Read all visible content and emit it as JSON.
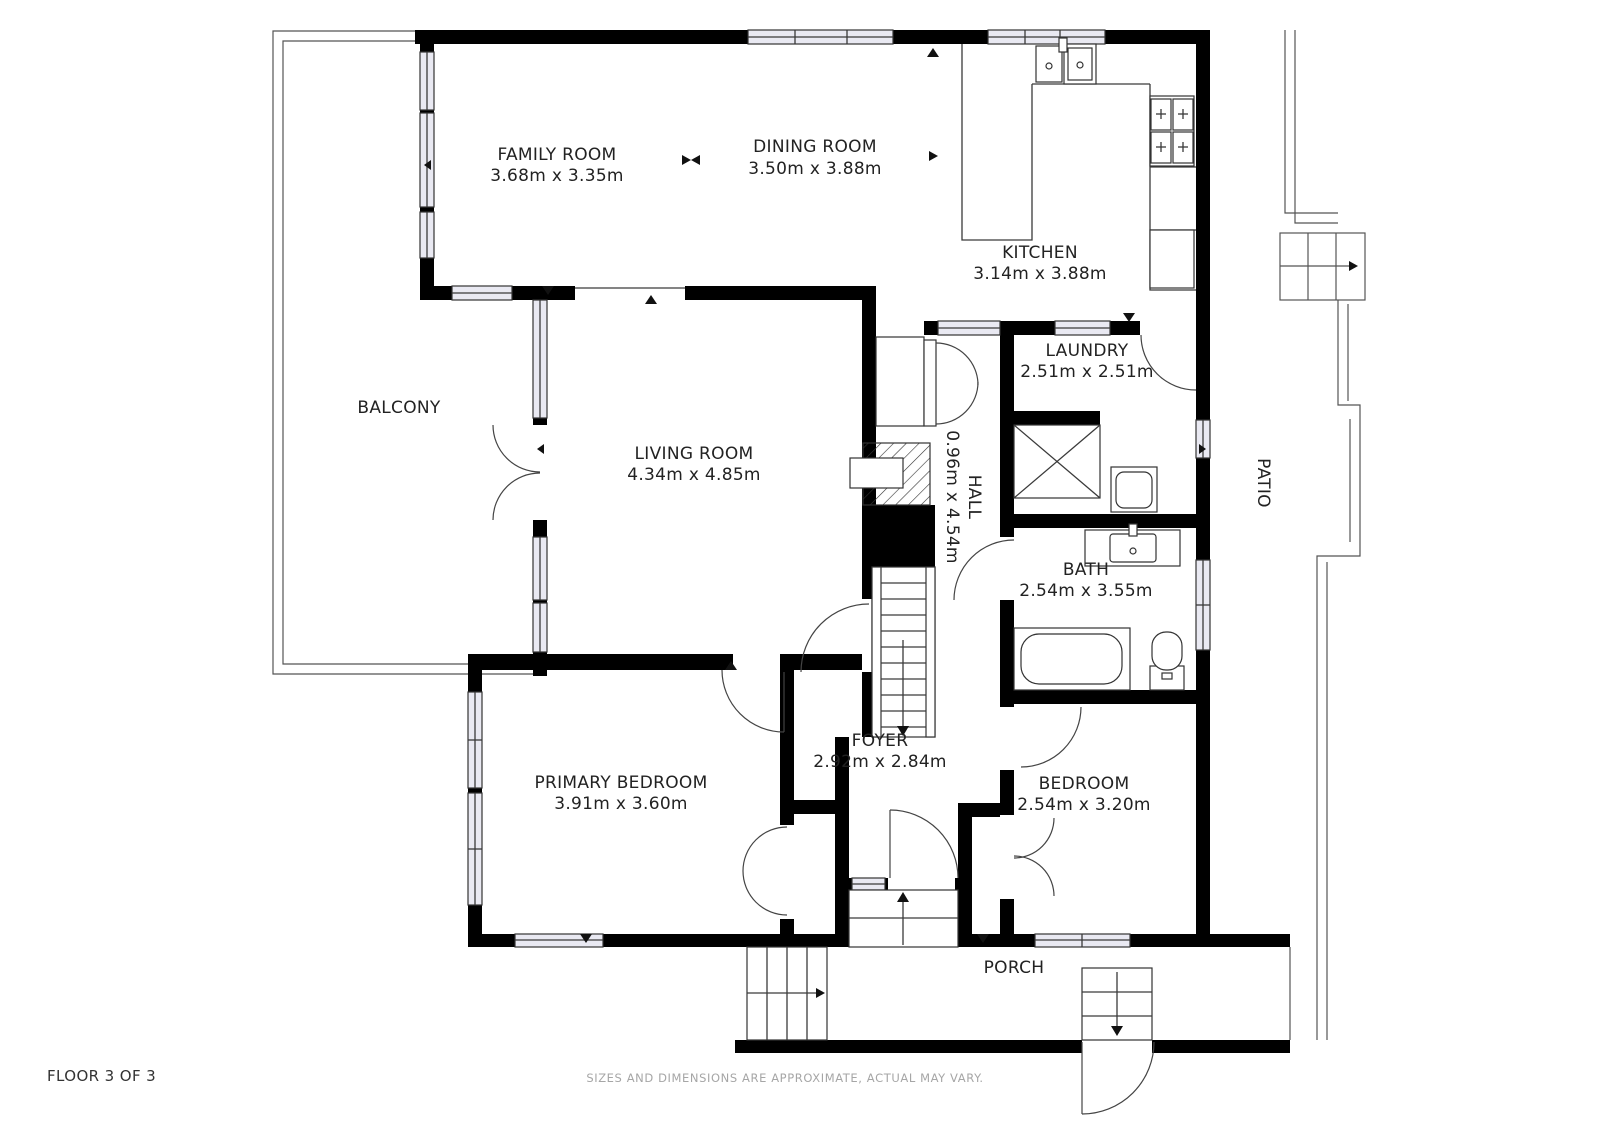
{
  "floor_plan": {
    "rooms": [
      {
        "name": "FAMILY ROOM",
        "dims": "3.68m x 3.35m"
      },
      {
        "name": "DINING ROOM",
        "dims": "3.50m x 3.88m"
      },
      {
        "name": "KITCHEN",
        "dims": "3.14m x 3.88m"
      },
      {
        "name": "LAUNDRY",
        "dims": "2.51m x 2.51m"
      },
      {
        "name": "BALCONY",
        "dims": ""
      },
      {
        "name": "LIVING ROOM",
        "dims": "4.34m x 4.85m"
      },
      {
        "name": "HALL",
        "dims": "0.96m x 4.54m"
      },
      {
        "name": "BATH",
        "dims": "2.54m x 3.55m"
      },
      {
        "name": "PATIO",
        "dims": ""
      },
      {
        "name": "FOYER",
        "dims": "2.92m x 2.84m"
      },
      {
        "name": "PRIMARY BEDROOM",
        "dims": "3.91m x 3.60m"
      },
      {
        "name": "BEDROOM",
        "dims": "2.54m x 3.20m"
      },
      {
        "name": "PORCH",
        "dims": ""
      }
    ],
    "footer": {
      "floor_label": "FLOOR 3 OF 3",
      "disclaimer": "SIZES AND DIMENSIONS ARE APPROXIMATE, ACTUAL MAY VARY."
    },
    "colors": {
      "wall": "#000000",
      "window_fill": "#e9e9f2",
      "line": "#3a3a3a",
      "label_text": "#222222",
      "disclaimer_text": "#a6a6a6"
    }
  }
}
